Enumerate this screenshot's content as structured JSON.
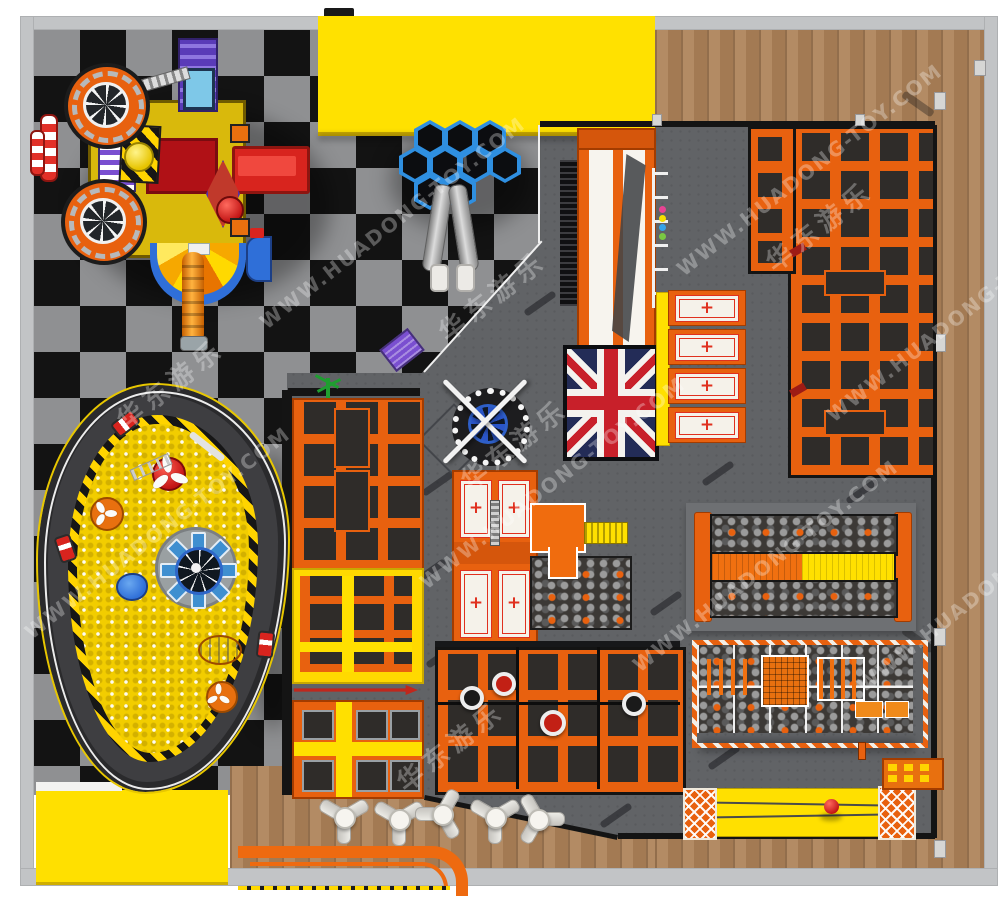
{
  "watermark": {
    "site": "WWW.HUADONG-TOY.COM",
    "brand_cn": "华东游乐"
  },
  "palette": {
    "accent_orange": "#e8610f",
    "accent_yellow": "#ffe000",
    "bed_dark": "#2f2c29",
    "slab_gray": "#616366",
    "checker_light": "#8f9092",
    "checker_dark": "#131313",
    "wood": "#ad8258",
    "track_gray": "#3e3e41",
    "uk_navy": "#232c57",
    "uk_red": "#c8202a",
    "hex_blue": "#2f8fe0",
    "ball_pit_yellow": "#f2cd00",
    "kart_red": "#d8241e"
  },
  "zones": {
    "banner": {
      "name": "yellow-banner"
    },
    "toddler_playground": {
      "name": "toddler-train-playground",
      "wheels": 2
    },
    "honeycomb": {
      "name": "honeycomb-climber",
      "hex_count": 9,
      "slide_tubes": 2
    },
    "giant_slide": {
      "name": "giant-drop-slide",
      "lanes": 2,
      "landing": "union-jack-mat"
    },
    "wall_beds": {
      "name": "airbag-wall-beds",
      "count": 4,
      "symbol": "+"
    },
    "main_trampoline_grid": {
      "name": "main-trampoline-grid",
      "rows": 9,
      "cols": 4
    },
    "foam_runway": {
      "name": "foam-pit-battle-beam",
      "lanes": 2
    },
    "ninja_course": {
      "name": "ninja-obstacle-course"
    },
    "lane_trampolines": {
      "name": "trampoline-lane-strip",
      "sections": 3
    },
    "wipeout": {
      "name": "wipeout-spinner",
      "dots": 10
    },
    "airbags": {
      "name": "airbag-beds",
      "count": 4,
      "symbol": "+"
    },
    "platform": {
      "name": "platform-with-stairs"
    },
    "foam_pit_small": {
      "name": "foam-pit"
    },
    "dodgeball": {
      "name": "dodgeball-trampoline-court",
      "rows": 3,
      "cols": 6,
      "balls": 4
    },
    "zipline": {
      "name": "zipline-runway",
      "cables": 2
    },
    "climbing_wall": {
      "name": "climbing-wall",
      "hold_rows": 2
    },
    "ball_pit": {
      "name": "ball-pit-with-go-kart-track",
      "karts": 3
    },
    "cafe": {
      "name": "cafe-seating",
      "tables": 5,
      "seats_per_table": 3
    },
    "bench": {
      "name": "curved-bench"
    }
  }
}
